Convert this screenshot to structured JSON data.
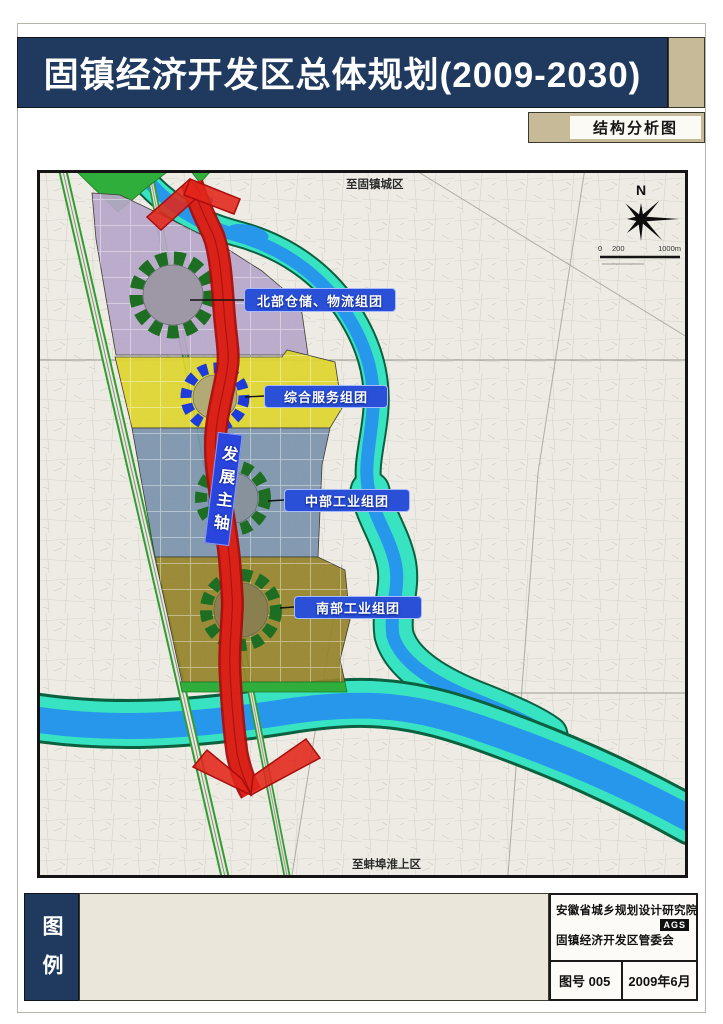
{
  "page": {
    "title": "固镇经济开发区总体规划(2009-2030)",
    "subtitle": "结构分析图"
  },
  "map": {
    "top_edge_label": "至固镇城区",
    "bottom_edge_label": "至蚌埠淮上区",
    "compass": "N",
    "scale": {
      "start": "0",
      "mid": "200",
      "end": "1000m"
    },
    "axis_label": "发展主轴",
    "clusters": [
      {
        "label": "北部仓储、物流组团"
      },
      {
        "label": "综合服务组团"
      },
      {
        "label": "中部工业组团"
      },
      {
        "label": "南部工业组团"
      }
    ]
  },
  "footer": {
    "legend_title": "图例",
    "design_institute": "安徽省城乡规划设计研究院",
    "institute_badge": "AGS",
    "client": "固镇经济开发区管委会",
    "sheet_label": "图号  005",
    "date": "2009年6月"
  },
  "colors": {
    "navy": "#1f3a5e",
    "tan": "#c7ba99",
    "label-blue": "#2a50d8",
    "axis-red": "#e3251a",
    "axis-red-dark": "#a90d0d",
    "zone-purple": "#b7a6c9",
    "zone-yellow": "#ddd52e",
    "zone-bluegray": "#7b92ac",
    "zone-olive": "#95832a",
    "river-cyan": "#38e3c2",
    "river-blue": "#2797ec",
    "ring-green": "#1d6e22",
    "ring-blue": "#1d3bdb",
    "road-green": "#2f9e2f"
  }
}
